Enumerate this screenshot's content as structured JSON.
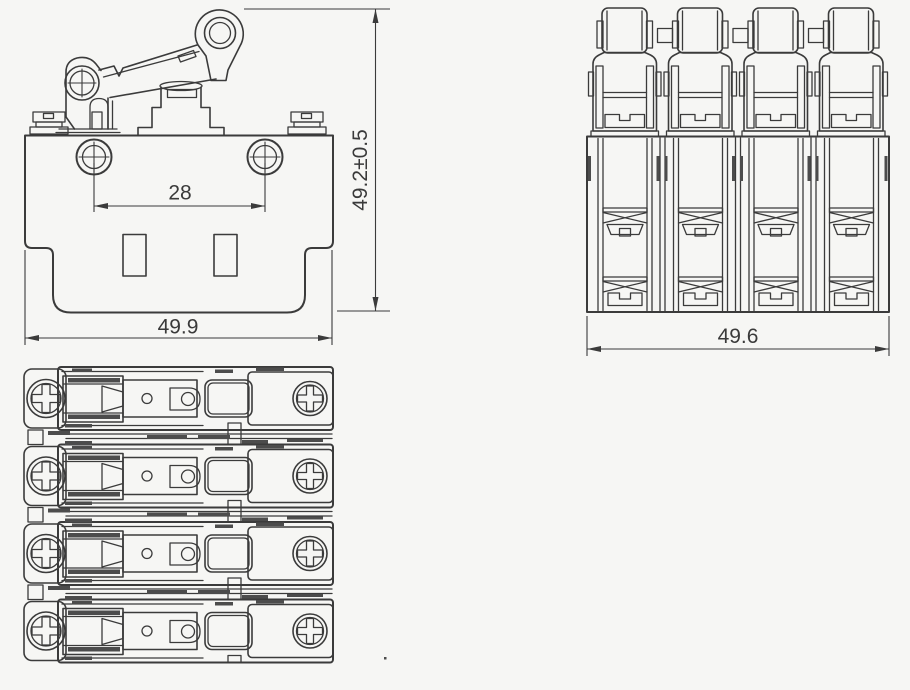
{
  "colors": {
    "background": "#f6f6f4",
    "line": "#3b3b3b",
    "dark_fill": "#4c4c4c",
    "text": "#3a3a3a"
  },
  "front_view": {
    "hole_spacing_label": "28",
    "width_label": "49.9",
    "height_label": "49.2±0.5"
  },
  "side_view": {
    "width_label": "49.6"
  }
}
